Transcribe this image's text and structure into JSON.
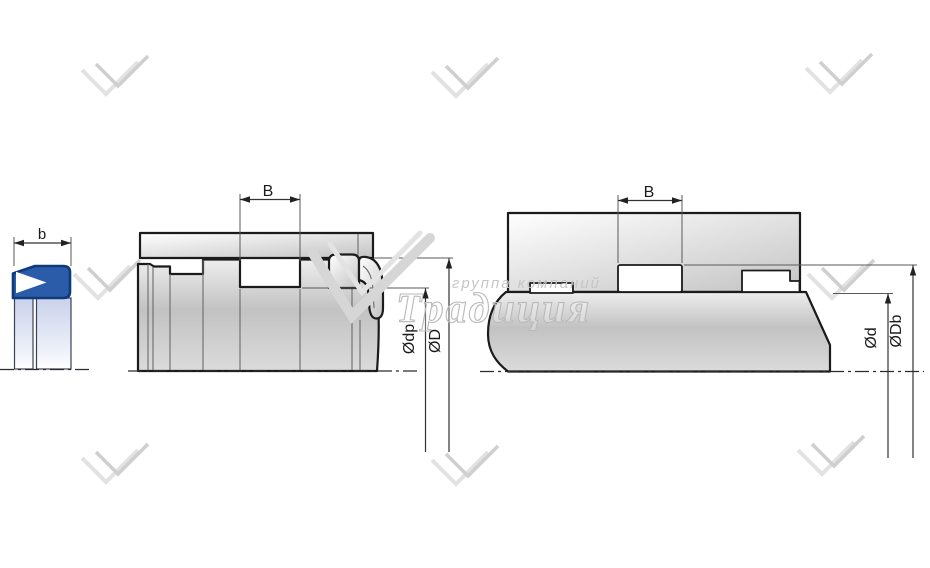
{
  "watermark": {
    "group_line": "группа компаний",
    "brand_line": "Традиция"
  },
  "figures": {
    "seal_profile": {
      "width_label": "b"
    },
    "rod_installation": {
      "groove_width_label": "B",
      "groove_diameter_label": "Ødp",
      "bore_diameter_label": "ØD"
    },
    "housing_installation": {
      "groove_width_label": "B",
      "shaft_diameter_label": "Ød",
      "groove_diameter_label": "ØDb"
    }
  },
  "colors": {
    "seal_blue": "#2b5ca9",
    "seal_outline": "#0e3a7a",
    "outline_black": "#1b1b1b",
    "dimension_gray": "#333333",
    "watermark_gray": "#d2d2d2"
  }
}
